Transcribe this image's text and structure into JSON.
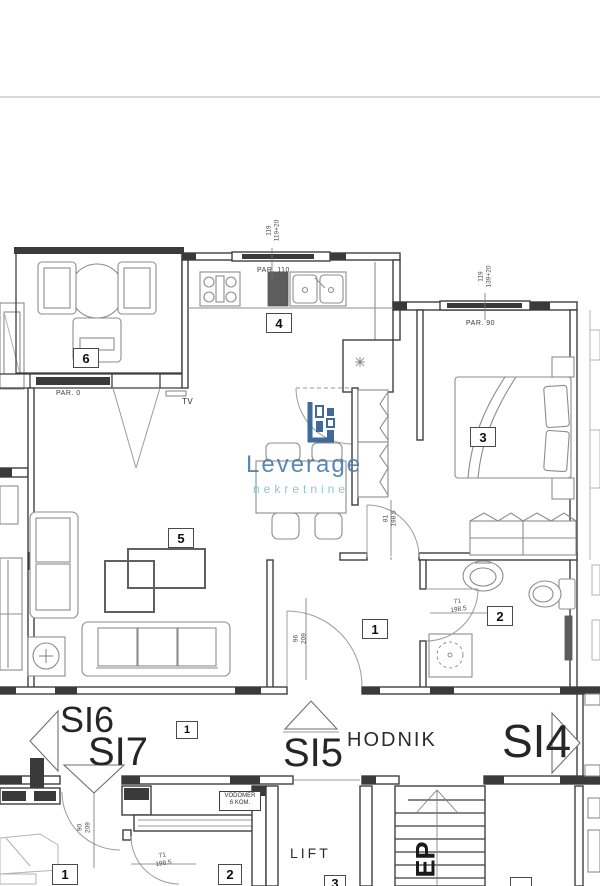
{
  "page": {
    "background": "#ffffff",
    "divider_color": "#dadada"
  },
  "logo": {
    "title": "Leverage",
    "subtitle": "nekretnine",
    "title_color": "#4d7dad",
    "subtitle_color": "#8ac2cf",
    "icon": "building-blocks-icon",
    "icon_color": "#2e5e94"
  },
  "rooms": {
    "terrace": "6",
    "kitchen": "4",
    "bedroom": "3",
    "living": "5",
    "hall": "1",
    "bathroom": "2"
  },
  "corridor": {
    "si6": "SI6",
    "si7": "SI7",
    "si5": "SI5",
    "si4": "SI4",
    "hodnik": "HODNIK",
    "unit_badge": "1"
  },
  "lower_floor": {
    "room1": "1",
    "room2": "2",
    "room3": "3",
    "lift": "LIFT",
    "stairs_label": "EP",
    "vodomer_line1": "VODOMER",
    "vodomer_line2": "6 KOM."
  },
  "annotations": {
    "par_terrace": "PAR. 0",
    "par_kitchen": "PAR. 110",
    "par_bedroom": "PAR. 90",
    "tv": "TV"
  },
  "dimensions": {
    "kitchen_window": {
      "a": "119",
      "b": "119+20"
    },
    "bedroom_window": {
      "a": "119",
      "b": "139+20"
    },
    "entrance_door": {
      "a": "96",
      "b": "209"
    },
    "closet_door": {
      "a": "81",
      "b": "198.5"
    },
    "bathroom_door": {
      "a": "71",
      "b": "198.5"
    },
    "lower_door1": {
      "a": "90",
      "b": "209"
    },
    "lower_door2": {
      "a": "71",
      "b": "198.5"
    }
  }
}
